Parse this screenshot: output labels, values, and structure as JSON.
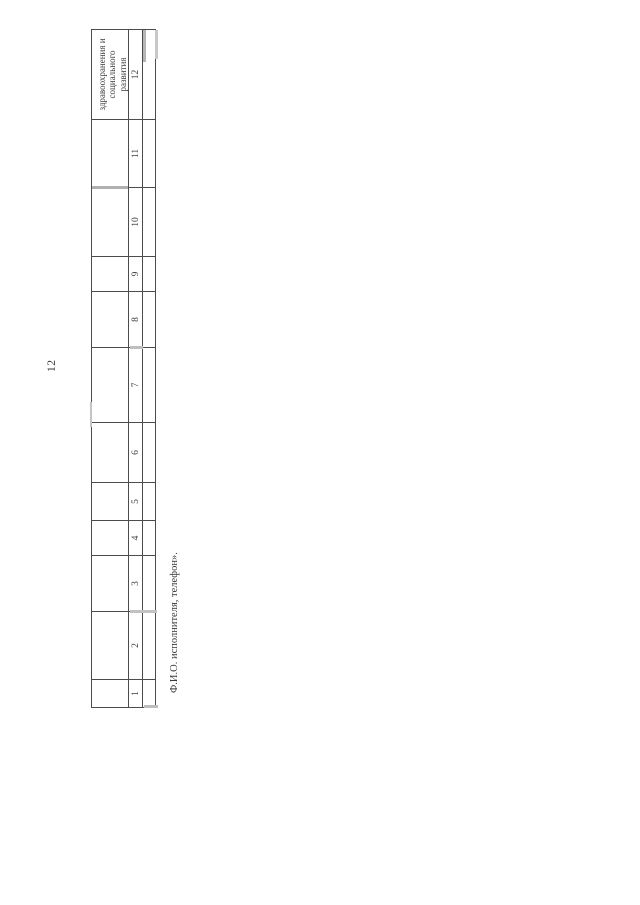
{
  "document": {
    "page_number": "12",
    "footer_note": "Ф.И.О. исполнителя, телефон»."
  },
  "table": {
    "header": {
      "col12_lines": [
        "здравоохранения и",
        "социального",
        "развития"
      ]
    },
    "column_numbers": [
      "1",
      "2",
      "3",
      "4",
      "5",
      "6",
      "7",
      "8",
      "9",
      "10",
      "11",
      "12"
    ],
    "rows": [
      [
        "",
        "",
        "",
        "",
        "",
        "",
        "",
        "",
        "",
        "",
        "",
        ""
      ]
    ]
  }
}
